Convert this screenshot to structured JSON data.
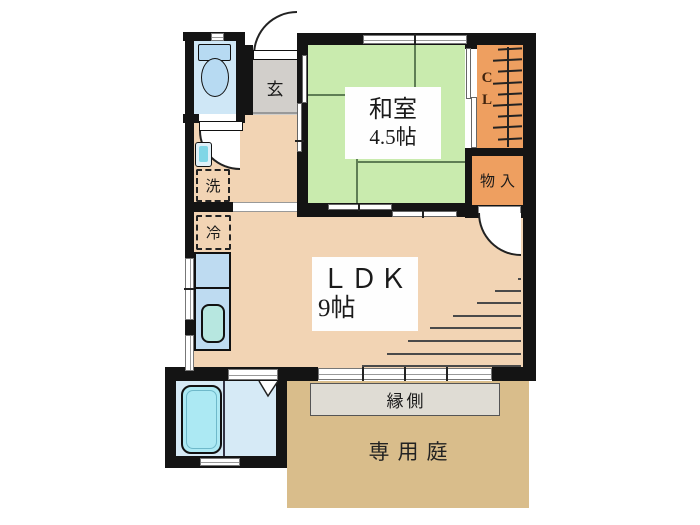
{
  "plan": {
    "type": "apartment-floor-plan",
    "rooms": {
      "genkan": {
        "label": "玄"
      },
      "washitsu": {
        "name": "和室",
        "size": "4.5帖"
      },
      "closet": {
        "line1": "C",
        "line2": "L"
      },
      "storage": {
        "label": "物入"
      },
      "ldk": {
        "name": "ＬＤＫ",
        "size": "9帖"
      },
      "washer": {
        "label": "洗"
      },
      "fridge": {
        "label": "冷"
      },
      "engawa": {
        "label": "縁側"
      },
      "garden": {
        "label": "専用庭"
      }
    },
    "colors": {
      "wall": "#141414",
      "washitsu_green": "#c9ebae",
      "ldk_peach": "#f2d4b4",
      "genkan_gray": "#d2cfcb",
      "closet_orange": "#ee9f60",
      "garden_tan": "#d9bd8b",
      "engawa_gray": "#dfdcd4",
      "bath_blue": "#d6eaf6",
      "tub_cyan": "#ace9f3",
      "fixture_blue": "#b7daf2",
      "counter_blue": "#bedbf1",
      "sink_teal": "#b7e7e0"
    }
  }
}
